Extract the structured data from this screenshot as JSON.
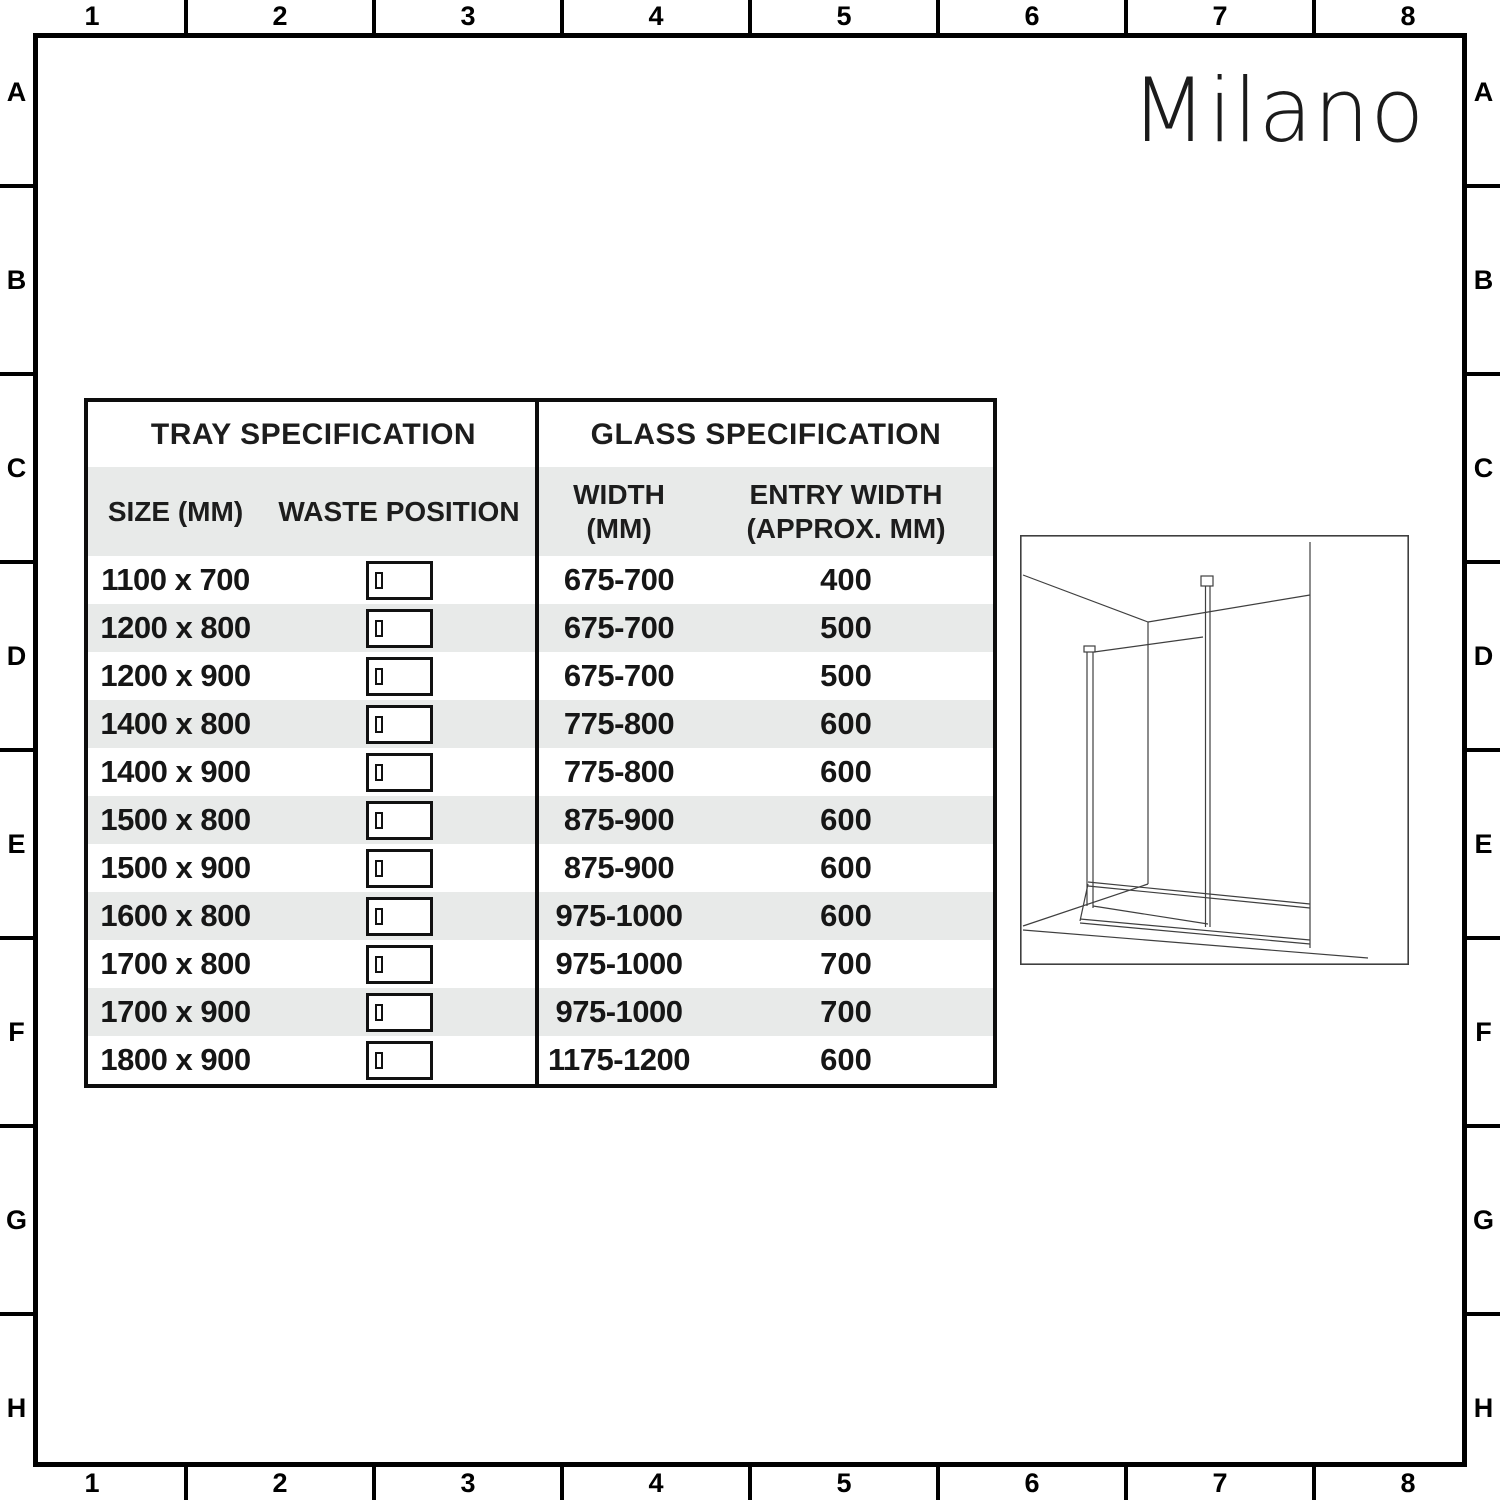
{
  "grid": {
    "cols": [
      "1",
      "2",
      "3",
      "4",
      "5",
      "6",
      "7",
      "8"
    ],
    "rows": [
      "A",
      "B",
      "C",
      "D",
      "E",
      "F",
      "G",
      "H"
    ]
  },
  "logo": {
    "text": "Milano"
  },
  "tray_table": {
    "title": "TRAY SPECIFICATION",
    "size_header": "SIZE (MM)",
    "waste_header": "WASTE POSITION"
  },
  "glass_table": {
    "title": "GLASS SPECIFICATION",
    "width_header_line1": "WIDTH",
    "width_header_line2": "(MM)",
    "entry_header_line1": "ENTRY WIDTH",
    "entry_header_line2": "(APPROX. MM)"
  },
  "rows": [
    {
      "size": "1100 x 700",
      "width": "675-700",
      "entry": "400"
    },
    {
      "size": "1200 x 800",
      "width": "675-700",
      "entry": "500"
    },
    {
      "size": "1200 x 900",
      "width": "675-700",
      "entry": "500"
    },
    {
      "size": "1400 x 800",
      "width": "775-800",
      "entry": "600"
    },
    {
      "size": "1400 x 900",
      "width": "775-800",
      "entry": "600"
    },
    {
      "size": "1500 x 800",
      "width": "875-900",
      "entry": "600"
    },
    {
      "size": "1500 x 900",
      "width": "875-900",
      "entry": "600"
    },
    {
      "size": "1600 x 800",
      "width": "975-1000",
      "entry": "600"
    },
    {
      "size": "1700 x 800",
      "width": "975-1000",
      "entry": "700"
    },
    {
      "size": "1700 x 900",
      "width": "975-1000",
      "entry": "700"
    },
    {
      "size": "1800 x 900",
      "width": "1175-1200",
      "entry": "600"
    }
  ],
  "diagram": {
    "name": "walk-in shower enclosure perspective drawing"
  },
  "colors": {
    "row_alt": "#e8eae9",
    "frame_border": "#000000",
    "table_border": "#0d0d0d",
    "text": "#1d1d1d",
    "diagram_line": "#3f3f3f"
  }
}
